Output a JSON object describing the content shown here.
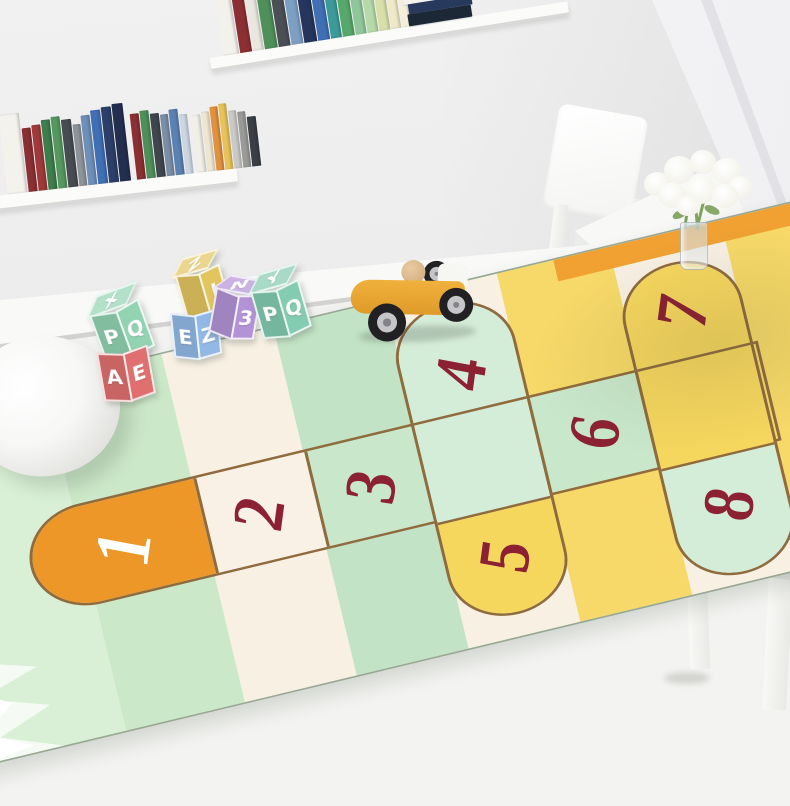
{
  "rug": {
    "outline_color": "#8f6b3e",
    "cells": [
      {
        "label": "1",
        "fill": "#ec9727",
        "label_color": "#ffffff"
      },
      {
        "label": "2",
        "fill": "#f9f1e5",
        "label_color": "#8b2132"
      },
      {
        "label": "3",
        "fill": "#c9e8cb",
        "label_color": "#8b2132"
      },
      {
        "label": "4",
        "fill": "#d4edd8",
        "label_color": "#8b2132"
      },
      {
        "label": "5",
        "fill": "#f6d75e",
        "label_color": "#8b2132"
      },
      {
        "label": "6",
        "fill": "#c9e8cb",
        "label_color": "#8b2132"
      },
      {
        "label": "7",
        "fill": "#f6d75e",
        "label_color": "#8b2132"
      },
      {
        "label": "8",
        "fill": "#d4edd8",
        "label_color": "#8b2132"
      }
    ],
    "stripes": [
      "#d9f0d6",
      "#cbe8c8",
      "#f8f0e3",
      "#c2e3c5",
      "#f8f0e3",
      "#f6d968",
      "#f8f0e3",
      "#f6d968",
      "#f6d968"
    ],
    "accent_strip": "#f0a132",
    "duck": {
      "panel": "#f49f2c",
      "body": "#ffd94a",
      "outline": "#ef8a1f",
      "cheek": "#f5a9c6"
    }
  },
  "blocks": [
    {
      "color": "#92d3b2",
      "letters": {
        "top": "X",
        "left": "P",
        "right": "Q"
      }
    },
    {
      "color": "#e07070",
      "letters": {
        "left": "A",
        "right": "E"
      }
    },
    {
      "color": "#e3c55f",
      "letters": {
        "top": "Z",
        "right": "I"
      }
    },
    {
      "color": "#92b9e6",
      "letters": {
        "left": "E",
        "right": "Z"
      }
    },
    {
      "color": "#b393d6",
      "letters": {
        "top": "N",
        "right": "3"
      }
    },
    {
      "color": "#83cbb1",
      "letters": {
        "top": "Y",
        "left": "P",
        "right": "Q"
      }
    }
  ],
  "books": {
    "top_shelf": [
      "#f2f1ec",
      "#8c2f33",
      "#e9e7df",
      "#4e8f5a",
      "#4a4f55",
      "#7d9fc4",
      "#26355c",
      "#3f6fb5",
      "#3c9b9a",
      "#57a86b",
      "#8fc79a",
      "#b5d9a8",
      "#d8dfa8",
      "#efe9c8",
      "#f4efda",
      "#ececea"
    ],
    "top_stack": [
      "#2e7d4f",
      "#f3f2ee",
      "#273a5e",
      "#1d2836"
    ],
    "left_shelf": [
      "#f3f2ed",
      "#8c2f33",
      "#a03a3a",
      "#3e7d4c",
      "#55975f",
      "#474c52",
      "#8e9399",
      "#6d8fb8",
      "#3f6fb5",
      "#2c3f68",
      "#222f4e",
      "#8c2f33",
      "#4e8f5a",
      "#40464d",
      "#7b8ea6",
      "#5b82b4",
      "#cdd6e0",
      "#f1efe8",
      "#efe6d2",
      "#e2923e",
      "#e8c25a",
      "#c9c9c7",
      "#9a9a98",
      "#3a3f45"
    ]
  },
  "toy_car": {
    "body": "#eaa738",
    "rear": "#f6f6f3",
    "wheel": "#212124",
    "hub": "#c6c6c9",
    "driver": "#dcb88e"
  },
  "decor": {
    "pouf": "#f7f7f5",
    "curtain": "#f2f2f4",
    "wall": "#ebebec",
    "floor": "#f3f3f1",
    "flowers": "#f8f7ef",
    "stems": "#7fa35f",
    "vase": "#dfe5e8"
  }
}
